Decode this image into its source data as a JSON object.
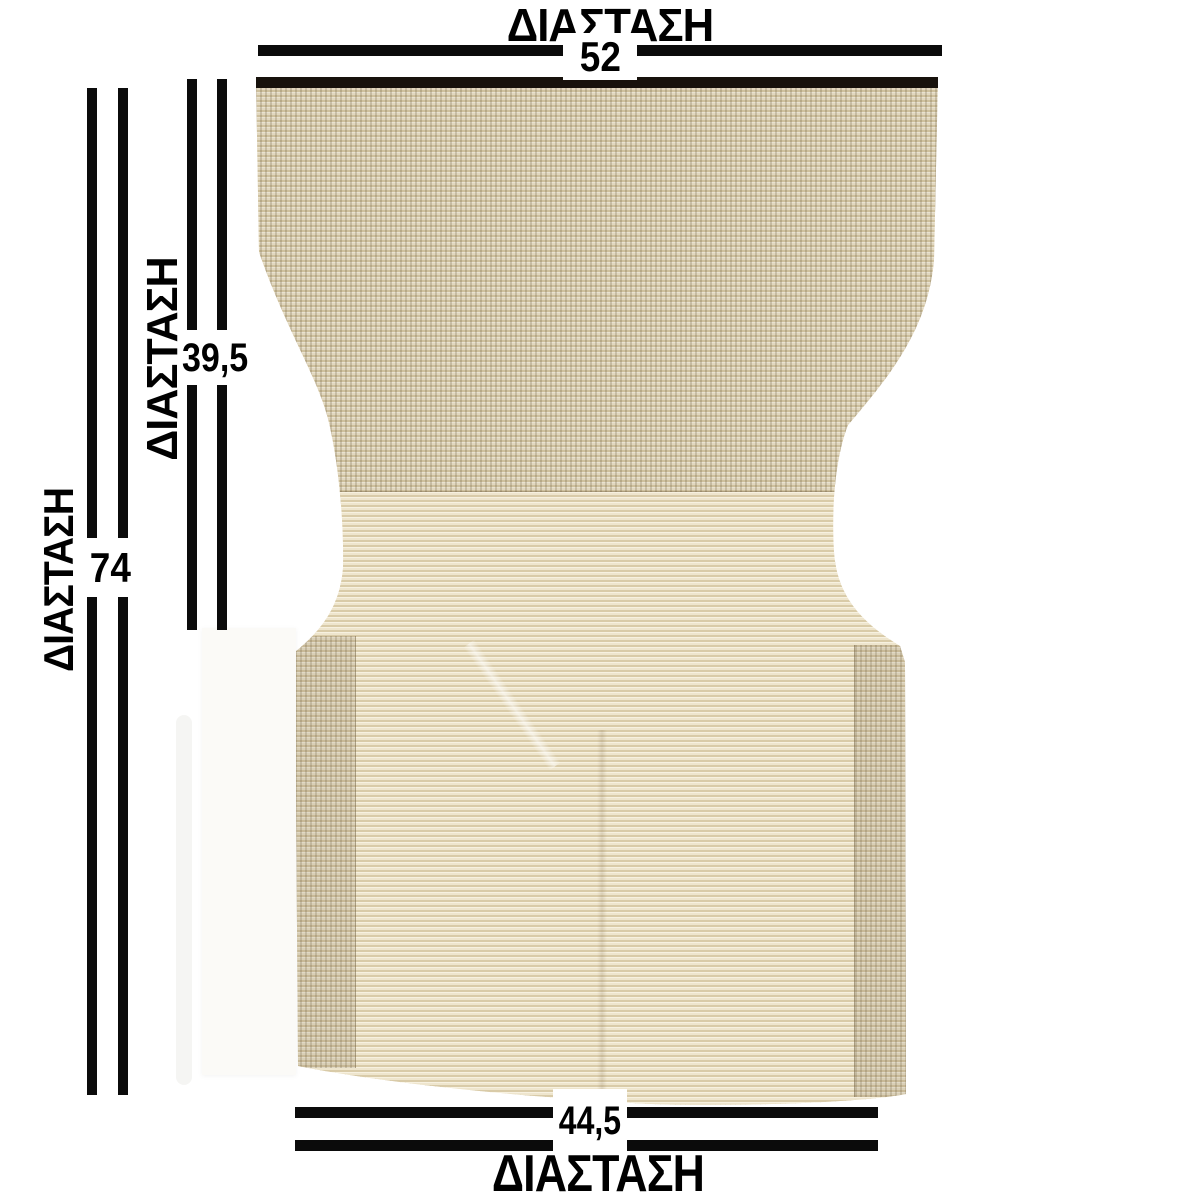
{
  "diagram": {
    "product": "chair-cover-fabric-panel",
    "labels": {
      "top": "ΔΙΑΣΤΑΣΗ",
      "bottom": "ΔΙΑΣΤΑΣΗ",
      "left_outer": "ΔΙΑΣΤΑΣΗ",
      "left_inner": "ΔΙΑΣΤΑΣΗ"
    },
    "values": {
      "top_width": "52",
      "left_height": "74",
      "inner_height": "39,5",
      "bottom_width": "44,5"
    },
    "colors": {
      "dimension_line": "#0b0b0b",
      "label_text": "#000000",
      "fabric_base": "#f2ead6",
      "fabric_weave": "#7c6846",
      "fabric_hem": "#17120c",
      "background": "#ffffff"
    }
  }
}
